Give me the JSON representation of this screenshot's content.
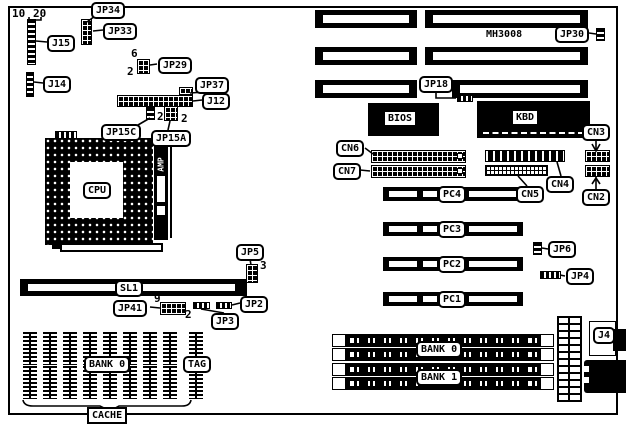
{
  "board": {
    "model": "MH3008"
  },
  "labels": {
    "jp34": "JP34",
    "jp33": "JP33",
    "j15": "J15",
    "j14": "J14",
    "jp29": "JP29",
    "jp37": "JP37",
    "j12": "J12",
    "jp15c": "JP15C",
    "jp15a": "JP15A",
    "cpu": "CPU",
    "amp": "AMP",
    "sl1": "SL1",
    "jp41": "JP41",
    "jp3": "JP3",
    "jp2": "JP2",
    "jp5": "JP5",
    "cache_bank0": "BANK 0",
    "tag": "TAG",
    "cache": "CACHE",
    "bios": "BIOS",
    "kbd": "KBD",
    "jp30": "JP30",
    "jp18": "JP18",
    "cn6": "CN6",
    "cn7": "CN7",
    "cn4": "CN4",
    "cn5": "CN5",
    "cn3": "CN3",
    "cn2": "CN2",
    "pc4": "PC4",
    "pc3": "PC3",
    "pc2": "PC2",
    "pc1": "PC1",
    "jp6": "JP6",
    "jp4": "JP4",
    "simm_bank0": "BANK 0",
    "simm_bank1": "BANK 1",
    "j4": "J4"
  },
  "pins": {
    "j15_first": "10",
    "j15_last": "20",
    "jp29_top": "6",
    "jp29_bottom": "2",
    "jp15c_pin": "2",
    "jp15a_pin": "2",
    "jp5_pin": "3",
    "jp41_top": "9",
    "jp41_bottom": "2"
  }
}
